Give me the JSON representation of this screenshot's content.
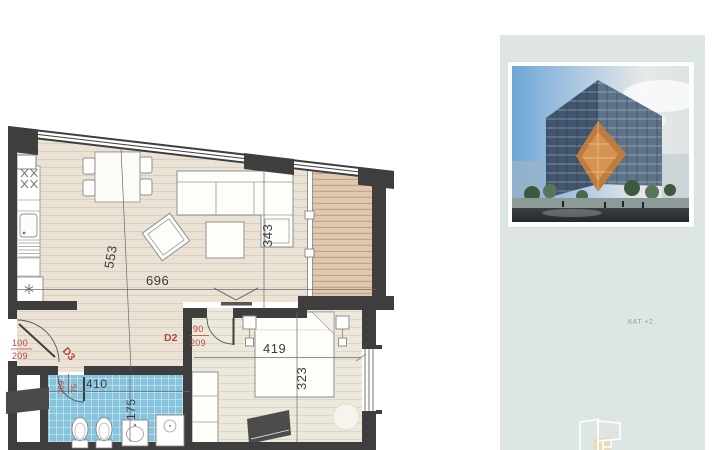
{
  "floor_plan": {
    "room_dimensions": {
      "living_width": "696",
      "living_depth": "553",
      "balcony_depth": "343",
      "bedroom_width": "419",
      "bedroom_depth": "323",
      "bathroom_width": "410",
      "bathroom_depth": "175"
    },
    "doors": {
      "entry": {
        "id": "D3",
        "width": "100",
        "height": "209"
      },
      "bedroom": {
        "id": "D2",
        "width": "90",
        "height": "209"
      },
      "bathroom": {
        "width": "75",
        "height": "209"
      }
    },
    "colors": {
      "wall": "#3e3e3e",
      "living_floor": "#eae3d5",
      "bedroom_floor": "#ede8dc",
      "balcony_deck": "#e0c8b0",
      "bathroom_tile": "#86c3dc",
      "door_label_red": "#b8453a"
    }
  },
  "side_panel": {
    "floor_label": "КАТ +2.",
    "background": "#dde6e2"
  }
}
